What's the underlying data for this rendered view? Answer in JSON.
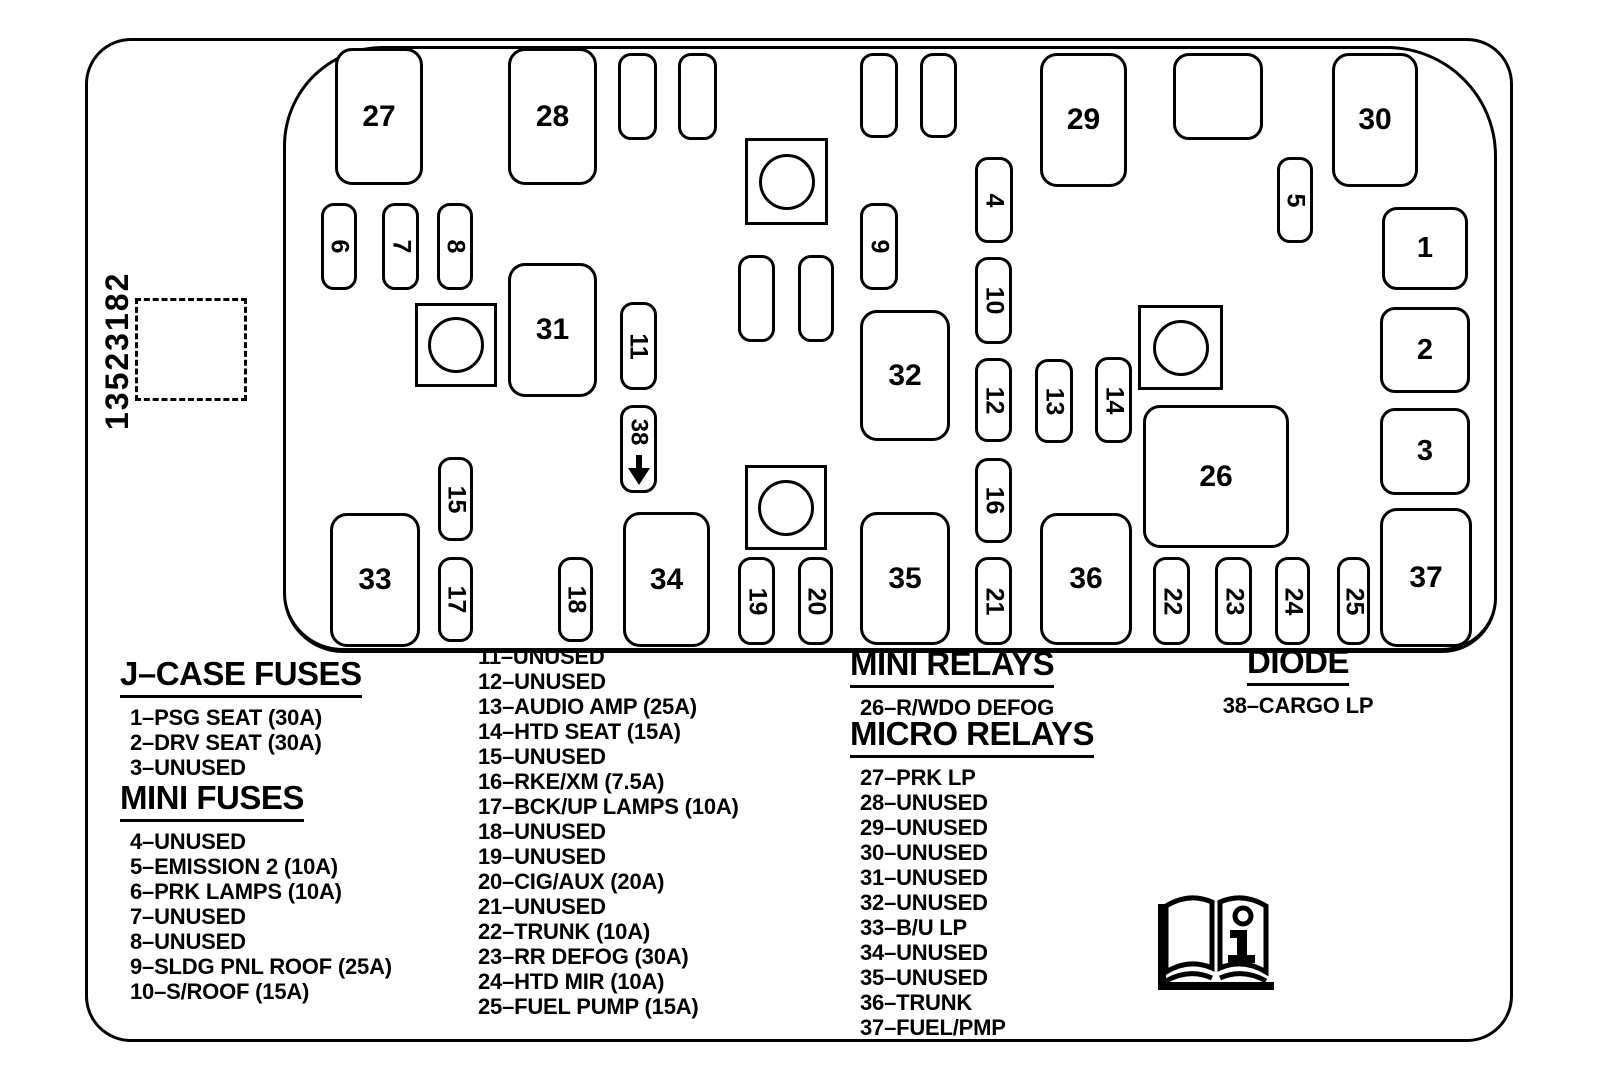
{
  "part_number": "13523182",
  "colors": {
    "ink": "#000000",
    "paper": "#ffffff"
  },
  "icons": {
    "manual_book": "open-book-info-icon",
    "diode_arrow": "down-arrow-icon"
  },
  "diagram": {
    "elements": [
      {
        "name": "fuse-27",
        "label": "27",
        "kind": "large",
        "x": 335,
        "y": 48,
        "w": 88,
        "h": 137
      },
      {
        "name": "fuse-28",
        "label": "28",
        "kind": "large",
        "x": 508,
        "y": 48,
        "w": 89,
        "h": 137
      },
      {
        "name": "unused-slot-a",
        "label": "",
        "kind": "small-blank",
        "x": 618,
        "y": 53,
        "w": 39,
        "h": 87
      },
      {
        "name": "unused-slot-b",
        "label": "",
        "kind": "small-blank",
        "x": 678,
        "y": 53,
        "w": 39,
        "h": 87
      },
      {
        "name": "relay-symbol-1",
        "label": "",
        "kind": "relay",
        "x": 745,
        "y": 138,
        "w": 83,
        "h": 87
      },
      {
        "name": "unused-slot-c",
        "label": "",
        "kind": "small-blank",
        "x": 860,
        "y": 53,
        "w": 38,
        "h": 85
      },
      {
        "name": "unused-slot-d",
        "label": "",
        "kind": "small-blank",
        "x": 920,
        "y": 53,
        "w": 37,
        "h": 85
      },
      {
        "name": "fuse-29",
        "label": "29",
        "kind": "large",
        "x": 1040,
        "y": 53,
        "w": 87,
        "h": 134
      },
      {
        "name": "unlabeled-square-slot",
        "label": "",
        "kind": "square-blank",
        "x": 1173,
        "y": 53,
        "w": 90,
        "h": 87
      },
      {
        "name": "fuse-30",
        "label": "30",
        "kind": "large",
        "x": 1332,
        "y": 53,
        "w": 86,
        "h": 134
      },
      {
        "name": "fuse-6",
        "label": "6",
        "kind": "small",
        "x": 321,
        "y": 203,
        "w": 36,
        "h": 87
      },
      {
        "name": "fuse-7",
        "label": "7",
        "kind": "small",
        "x": 382,
        "y": 203,
        "w": 37,
        "h": 87
      },
      {
        "name": "fuse-8",
        "label": "8",
        "kind": "small",
        "x": 437,
        "y": 203,
        "w": 36,
        "h": 87
      },
      {
        "name": "fuse-9",
        "label": "9",
        "kind": "small",
        "x": 860,
        "y": 203,
        "w": 38,
        "h": 87
      },
      {
        "name": "fuse-4",
        "label": "4",
        "kind": "small",
        "x": 975,
        "y": 157,
        "w": 38,
        "h": 86
      },
      {
        "name": "fuse-5",
        "label": "5",
        "kind": "small",
        "x": 1277,
        "y": 157,
        "w": 36,
        "h": 86
      },
      {
        "name": "fuse-1",
        "label": "1",
        "kind": "jcase",
        "x": 1382,
        "y": 207,
        "w": 86,
        "h": 83
      },
      {
        "name": "fuse-10",
        "label": "10",
        "kind": "small",
        "x": 975,
        "y": 257,
        "w": 37,
        "h": 87
      },
      {
        "name": "relay-symbol-2",
        "label": "",
        "kind": "relay",
        "x": 415,
        "y": 303,
        "w": 82,
        "h": 84
      },
      {
        "name": "fuse-31",
        "label": "31",
        "kind": "large",
        "x": 508,
        "y": 263,
        "w": 89,
        "h": 134
      },
      {
        "name": "fuse-11",
        "label": "11",
        "kind": "small",
        "x": 620,
        "y": 302,
        "w": 37,
        "h": 88
      },
      {
        "name": "unused-slot-e",
        "label": "",
        "kind": "small-blank",
        "x": 738,
        "y": 255,
        "w": 37,
        "h": 87
      },
      {
        "name": "unused-slot-f",
        "label": "",
        "kind": "small-blank",
        "x": 798,
        "y": 255,
        "w": 36,
        "h": 87
      },
      {
        "name": "fuse-32",
        "label": "32",
        "kind": "large",
        "x": 860,
        "y": 310,
        "w": 90,
        "h": 131
      },
      {
        "name": "fuse-12",
        "label": "12",
        "kind": "small",
        "x": 975,
        "y": 358,
        "w": 37,
        "h": 84
      },
      {
        "name": "fuse-13",
        "label": "13",
        "kind": "small",
        "x": 1035,
        "y": 359,
        "w": 38,
        "h": 84
      },
      {
        "name": "fuse-14",
        "label": "14",
        "kind": "small",
        "x": 1095,
        "y": 357,
        "w": 37,
        "h": 86
      },
      {
        "name": "relay-symbol-3",
        "label": "",
        "kind": "relay",
        "x": 1138,
        "y": 305,
        "w": 85,
        "h": 85
      },
      {
        "name": "fuse-2",
        "label": "2",
        "kind": "jcase",
        "x": 1380,
        "y": 307,
        "w": 90,
        "h": 86
      },
      {
        "name": "diode-38",
        "label": "38",
        "kind": "diode",
        "x": 620,
        "y": 405,
        "w": 37,
        "h": 88
      },
      {
        "name": "relay-26",
        "label": "26",
        "kind": "large",
        "x": 1143,
        "y": 405,
        "w": 146,
        "h": 143
      },
      {
        "name": "fuse-3",
        "label": "3",
        "kind": "jcase",
        "x": 1380,
        "y": 408,
        "w": 90,
        "h": 87
      },
      {
        "name": "fuse-15",
        "label": "15",
        "kind": "small",
        "x": 438,
        "y": 457,
        "w": 35,
        "h": 84
      },
      {
        "name": "fuse-16",
        "label": "16",
        "kind": "small",
        "x": 975,
        "y": 458,
        "w": 37,
        "h": 85
      },
      {
        "name": "relay-symbol-4",
        "label": "",
        "kind": "relay",
        "x": 745,
        "y": 465,
        "w": 82,
        "h": 85
      },
      {
        "name": "relay-33",
        "label": "33",
        "kind": "large",
        "x": 330,
        "y": 513,
        "w": 90,
        "h": 134
      },
      {
        "name": "fuse-17",
        "label": "17",
        "kind": "small",
        "x": 438,
        "y": 557,
        "w": 35,
        "h": 85
      },
      {
        "name": "fuse-18",
        "label": "18",
        "kind": "small",
        "x": 558,
        "y": 557,
        "w": 35,
        "h": 85
      },
      {
        "name": "relay-34",
        "label": "34",
        "kind": "large",
        "x": 623,
        "y": 512,
        "w": 87,
        "h": 135
      },
      {
        "name": "fuse-19",
        "label": "19",
        "kind": "small",
        "x": 738,
        "y": 557,
        "w": 37,
        "h": 88
      },
      {
        "name": "fuse-20",
        "label": "20",
        "kind": "small",
        "x": 798,
        "y": 557,
        "w": 35,
        "h": 88
      },
      {
        "name": "relay-35",
        "label": "35",
        "kind": "large",
        "x": 860,
        "y": 512,
        "w": 90,
        "h": 133
      },
      {
        "name": "fuse-21",
        "label": "21",
        "kind": "small",
        "x": 975,
        "y": 557,
        "w": 37,
        "h": 88
      },
      {
        "name": "relay-36",
        "label": "36",
        "kind": "large",
        "x": 1040,
        "y": 513,
        "w": 92,
        "h": 132
      },
      {
        "name": "fuse-22",
        "label": "22",
        "kind": "small",
        "x": 1153,
        "y": 557,
        "w": 37,
        "h": 88
      },
      {
        "name": "fuse-23",
        "label": "23",
        "kind": "small",
        "x": 1215,
        "y": 557,
        "w": 37,
        "h": 88
      },
      {
        "name": "fuse-24",
        "label": "24",
        "kind": "small",
        "x": 1275,
        "y": 557,
        "w": 35,
        "h": 88
      },
      {
        "name": "fuse-25",
        "label": "25",
        "kind": "small",
        "x": 1337,
        "y": 557,
        "w": 33,
        "h": 88
      },
      {
        "name": "relay-37",
        "label": "37",
        "kind": "large",
        "x": 1380,
        "y": 508,
        "w": 92,
        "h": 139
      }
    ]
  },
  "legend": {
    "sections": [
      {
        "heading": "J–CASE FUSES",
        "items": [
          "1–PSG SEAT (30A)",
          "2–DRV SEAT (30A)",
          "3–UNUSED"
        ]
      },
      {
        "heading": "MINI FUSES",
        "items": [
          "4–UNUSED",
          "5–EMISSION 2 (10A)",
          "6–PRK LAMPS (10A)",
          "7–UNUSED",
          "8–UNUSED",
          "9–SLDG PNL ROOF (25A)",
          "10–S/ROOF (15A)"
        ]
      },
      {
        "heading": "",
        "items": [
          "11–UNUSED",
          "12–UNUSED",
          "13–AUDIO AMP (25A)",
          "14–HTD SEAT (15A)",
          "15–UNUSED",
          "16–RKE/XM (7.5A)",
          "17–BCK/UP LAMPS (10A)",
          "18–UNUSED",
          "19–UNUSED",
          "20–CIG/AUX (20A)",
          "21–UNUSED",
          "22–TRUNK (10A)",
          "23–RR DEFOG (30A)",
          "24–HTD MIR (10A)",
          "25–FUEL PUMP (15A)"
        ]
      },
      {
        "heading": "MINI RELAYS",
        "items": [
          "26–R/WDO DEFOG"
        ]
      },
      {
        "heading": "MICRO RELAYS",
        "items": [
          "27–PRK LP",
          "28–UNUSED",
          "29–UNUSED",
          "30–UNUSED",
          "31–UNUSED",
          "32–UNUSED",
          "33–B/U LP",
          "34–UNUSED",
          "35–UNUSED",
          "36–TRUNK",
          "37–FUEL/PMP"
        ]
      },
      {
        "heading": "DIODE",
        "items": [
          "38–CARGO LP"
        ]
      }
    ]
  }
}
